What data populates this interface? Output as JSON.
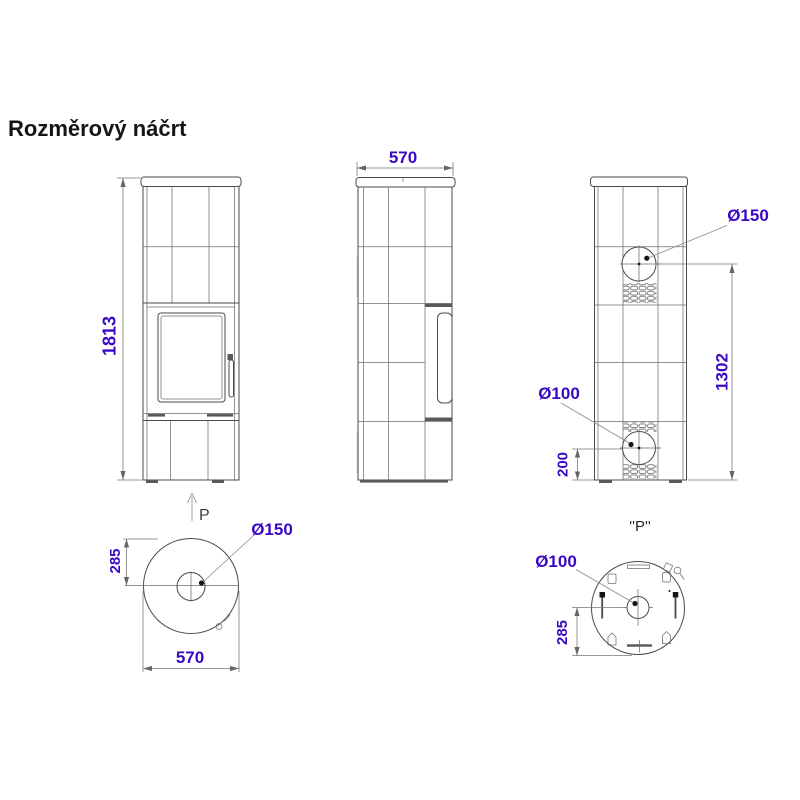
{
  "title": "Rozměrový náčrt",
  "colors": {
    "dimension_text": "#3A08C6",
    "drawing_line": "#4A4A4A"
  },
  "front_view": {
    "height": "1813",
    "view_direction_label": "P"
  },
  "side_view": {
    "width": "570"
  },
  "rear_view": {
    "flue_diameter": "Ø150",
    "flue_center_height": "1302",
    "inlet_diameter": "Ø100",
    "inlet_center_height": "200"
  },
  "top_view": {
    "flue_diameter": "Ø150",
    "flue_center_offset": "285",
    "width": "570"
  },
  "bottom_view": {
    "label": "''P''",
    "inlet_diameter": "Ø100",
    "inlet_center_offset": "285"
  }
}
